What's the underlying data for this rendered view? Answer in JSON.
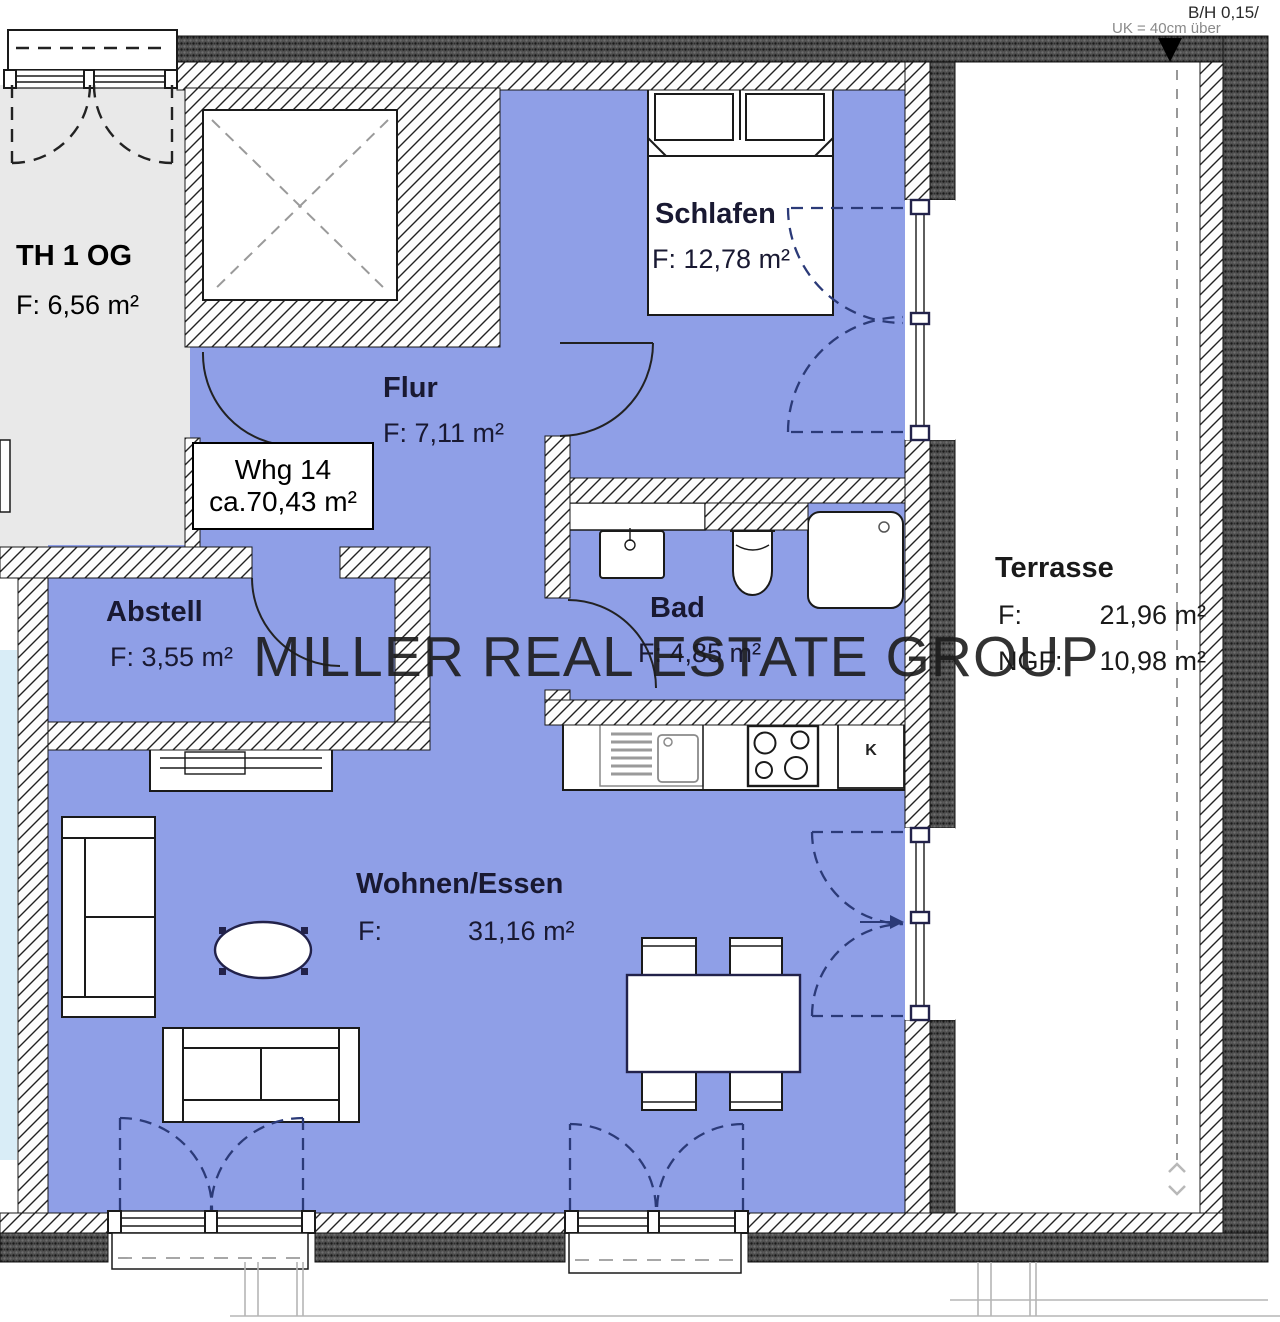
{
  "annotations": {
    "top_right_line1": "B/H 0,15/",
    "top_right_line2": "UK = 40cm über",
    "watermark": "MILLER REAL ESTATE GROUP"
  },
  "unit_label": {
    "line1": "Whg 14",
    "line2": "ca.70,43 m²"
  },
  "rooms": {
    "th": {
      "name": "TH 1 OG",
      "area": "F: 6,56 m²"
    },
    "schlafen": {
      "name": "Schlafen",
      "area": "F: 12,78 m²"
    },
    "flur": {
      "name": "Flur",
      "area": "F: 7,11 m²"
    },
    "bad": {
      "name": "Bad",
      "area": "F: 4,85 m²"
    },
    "abstell": {
      "name": "Abstell",
      "area": "F: 3,55 m²"
    },
    "wohnen": {
      "name": "Wohnen/Essen",
      "area_label": "F:",
      "area_value": "31,16 m²"
    },
    "terrasse": {
      "name": "Terrasse",
      "f_label": "F:",
      "f_value": "21,96 m²",
      "ngf_label": "NGF:",
      "ngf_value": "10,98 m²"
    }
  },
  "kitchen": {
    "fridge_label": "K"
  },
  "colors": {
    "room_fill": "#8f9fe7",
    "th_fill": "#e9e9e9",
    "adj_fill": "#d9edf7",
    "label": "#191932",
    "arc_blue": "#2b3a78"
  }
}
